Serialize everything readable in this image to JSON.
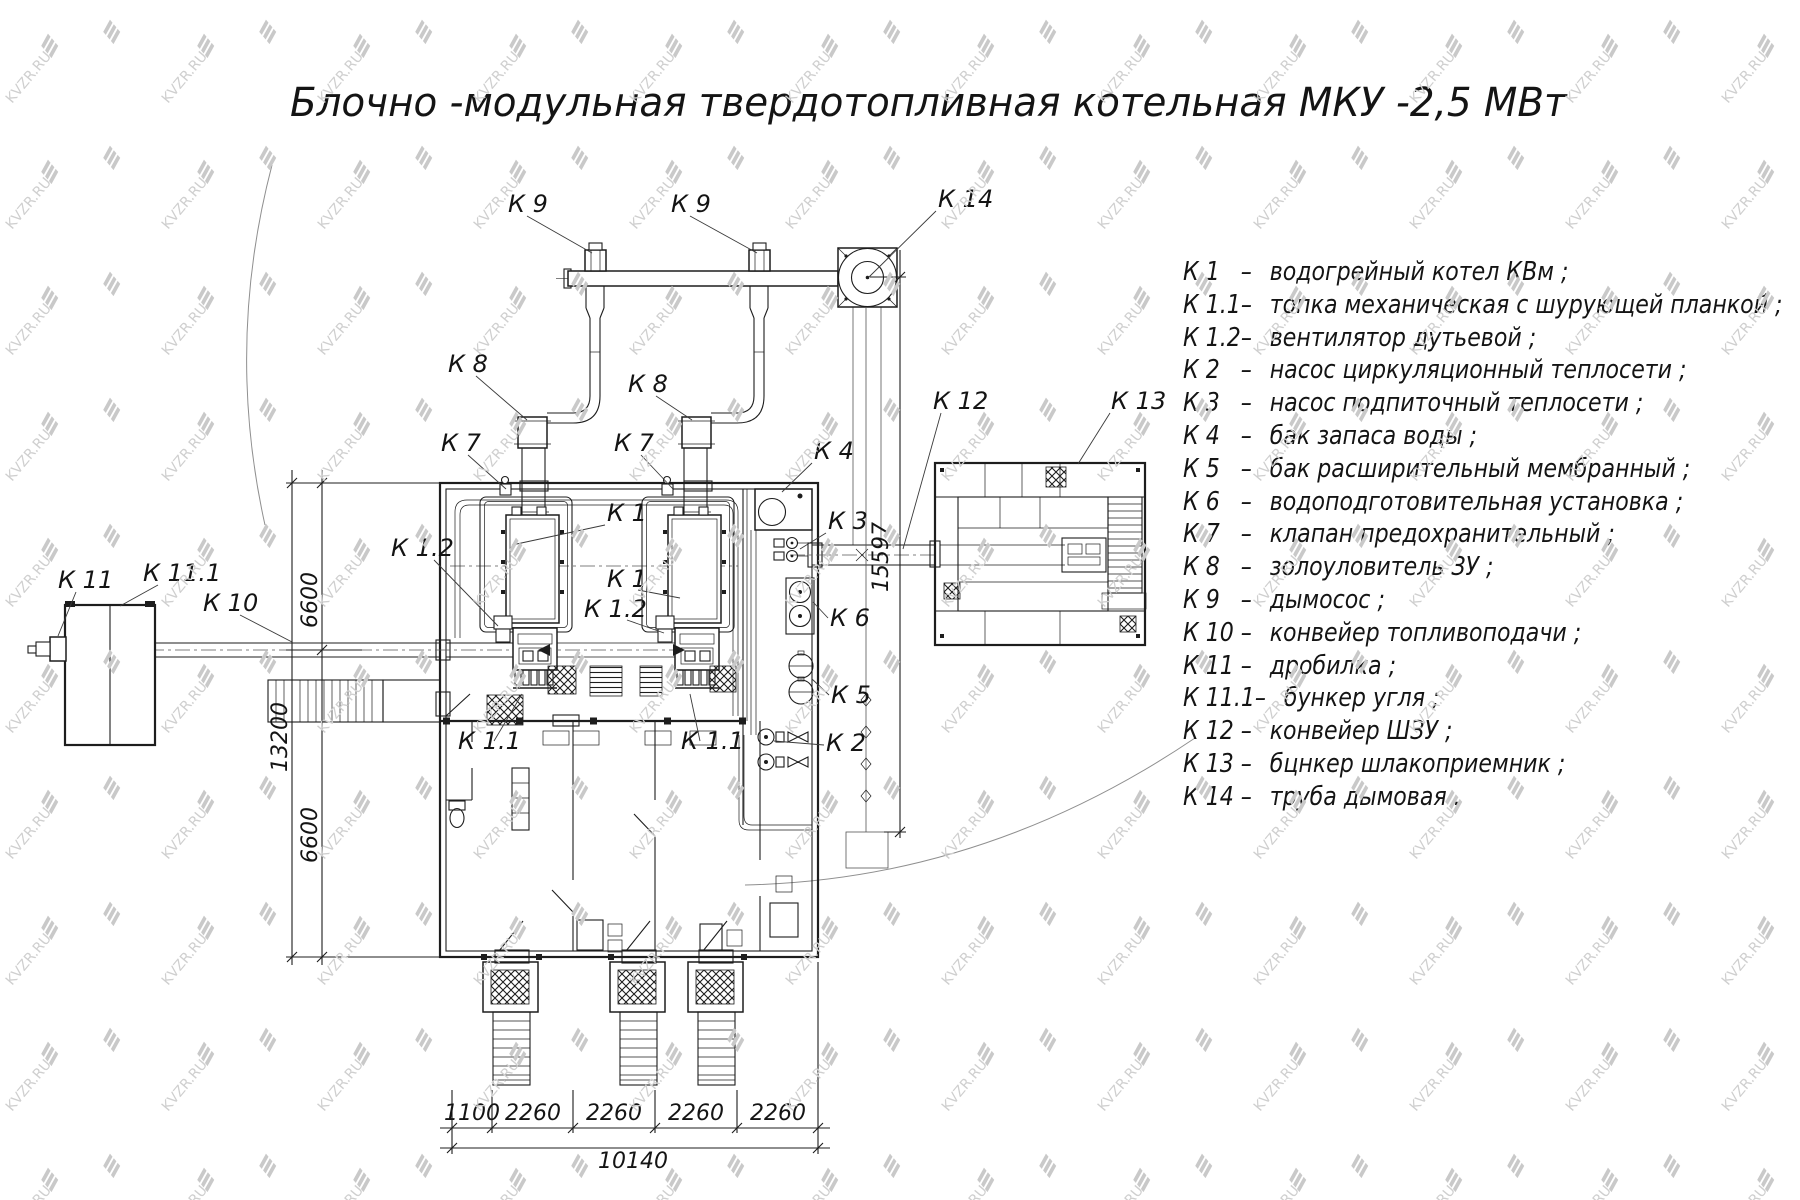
{
  "title": "Блочно -модульная твердотопливная котельная МКУ -2,5  МВт",
  "watermark_text": "KVZR.RU",
  "legend": {
    "items": [
      {
        "code": "К 1",
        "dash": "–",
        "desc": "водогрейный котел КВм ;"
      },
      {
        "code": "К 1.1",
        "dash": "–",
        "desc": "топка механическая с шурующей планкой ;"
      },
      {
        "code": "К 1.2",
        "dash": "–",
        "desc": "вентилятор дутьевой ;"
      },
      {
        "code": "К 2",
        "dash": "–",
        "desc": "насос циркуляционный теплосети ;"
      },
      {
        "code": "К 3",
        "dash": "–",
        "desc": "насос подпиточный теплосети ;"
      },
      {
        "code": "К 4",
        "dash": "–",
        "desc": "бак запаса воды ;"
      },
      {
        "code": "К 5",
        "dash": "–",
        "desc": "бак расширительный мембранный ;"
      },
      {
        "code": "К 6",
        "dash": "–",
        "desc": "водоподготовительная установка ;"
      },
      {
        "code": "К 7",
        "dash": "–",
        "desc": "клапан предохранительный ;"
      },
      {
        "code": "К 8",
        "dash": "–",
        "desc": "золоуловитель ЗУ ;"
      },
      {
        "code": "К 9",
        "dash": "–",
        "desc": "дымосос ;"
      },
      {
        "code": "К 10",
        "dash": "–",
        "desc": "конвейер топливоподачи ;"
      },
      {
        "code": "К 11",
        "dash": "–",
        "desc": "дробилка ;"
      },
      {
        "code": "К 11.1",
        "dash": "–",
        "desc": "бункер угля ;"
      },
      {
        "code": "К 12",
        "dash": "–",
        "desc": "конвейер ШЗУ ;"
      },
      {
        "code": "К 13",
        "dash": "–",
        "desc": "бцнкер шлакоприемник ;"
      },
      {
        "code": "К 14",
        "dash": "–",
        "desc": "труба дымовая ."
      }
    ]
  },
  "callouts": [
    {
      "text": "К 9",
      "x": 508,
      "y": 212,
      "leader": "527,216 592,253"
    },
    {
      "text": "К 9",
      "x": 671,
      "y": 212,
      "leader": "690,216 757,253"
    },
    {
      "text": "К 14",
      "x": 938,
      "y": 207,
      "leader": "936,211 869,277"
    },
    {
      "text": "К 8",
      "x": 448,
      "y": 372,
      "leader": "476,376 527,420"
    },
    {
      "text": "К 8",
      "x": 628,
      "y": 392,
      "leader": "656,396 692,420"
    },
    {
      "text": "К 7",
      "x": 441,
      "y": 451,
      "leader": "468,455 506,489"
    },
    {
      "text": "К 7",
      "x": 614,
      "y": 451,
      "leader": "641,455 673,489"
    },
    {
      "text": "К 4",
      "x": 814,
      "y": 459,
      "leader": "812,463 782,492"
    },
    {
      "text": "К 1",
      "x": 607,
      "y": 521,
      "leader": "605,525 512,545"
    },
    {
      "text": "К 1",
      "x": 607,
      "y": 587,
      "leader": "638,590 680,598"
    },
    {
      "text": "К 1.2",
      "x": 391,
      "y": 556,
      "leader": "434,560 498,626"
    },
    {
      "text": "К 1.2",
      "x": 584,
      "y": 617,
      "leader": "627,620 664,633"
    },
    {
      "text": "К 3",
      "x": 828,
      "y": 529,
      "leader": "826,533 800,549"
    },
    {
      "text": "К 6",
      "x": 830,
      "y": 626,
      "leader": "828,618 813,602"
    },
    {
      "text": "К 5",
      "x": 831,
      "y": 703,
      "leader": "829,695 812,679"
    },
    {
      "text": "К 2",
      "x": 826,
      "y": 751,
      "leader": "824,745 774,741"
    },
    {
      "text": "К 1.1",
      "x": 458,
      "y": 749,
      "leader": "494,741 522,694"
    },
    {
      "text": "К 1.1",
      "x": 681,
      "y": 749,
      "leader": "700,741 690,694"
    },
    {
      "text": "К 10",
      "x": 203,
      "y": 611,
      "leader": "240,615 292,642"
    },
    {
      "text": "К 11",
      "x": 58,
      "y": 588,
      "leader": "76,592 58,636"
    },
    {
      "text": "К 11.1",
      "x": 143,
      "y": 581,
      "leader": "158,585 120,606"
    },
    {
      "text": "К 12",
      "x": 933,
      "y": 409,
      "leader": "941,413 903,549"
    },
    {
      "text": "К 13",
      "x": 1111,
      "y": 409,
      "leader": "1110,413 1078,464"
    }
  ],
  "dimensions": [
    {
      "text": "6600",
      "x": 317,
      "y": 600,
      "rotate": -90
    },
    {
      "text": "13200",
      "x": 287,
      "y": 737,
      "rotate": -90
    },
    {
      "text": "6600",
      "x": 317,
      "y": 835,
      "rotate": -90
    },
    {
      "text": "15597",
      "x": 888,
      "y": 557,
      "rotate": -90
    },
    {
      "text": "1100",
      "x": 472,
      "y": 1120
    },
    {
      "text": "2260",
      "x": 533,
      "y": 1120
    },
    {
      "text": "2260",
      "x": 614,
      "y": 1120
    },
    {
      "text": "2260",
      "x": 696,
      "y": 1120
    },
    {
      "text": "2260",
      "x": 778,
      "y": 1120
    },
    {
      "text": "10140",
      "x": 633,
      "y": 1168
    }
  ]
}
